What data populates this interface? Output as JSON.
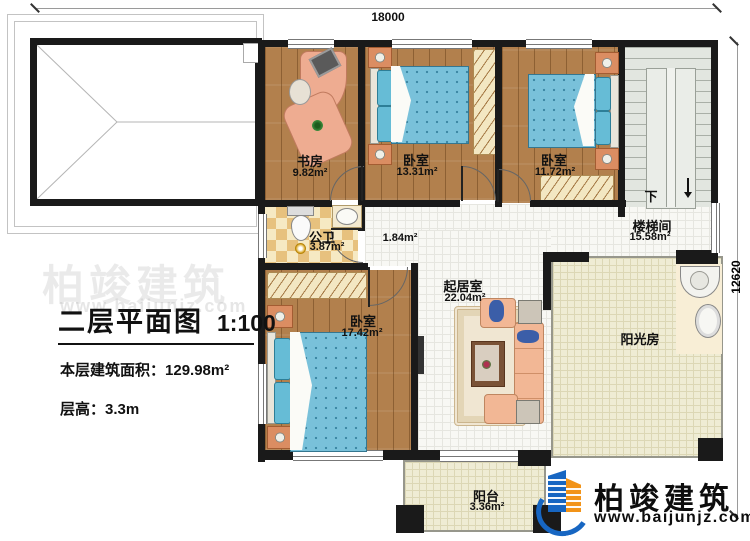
{
  "meta": {
    "dim_top": "18000",
    "dim_right": "12620"
  },
  "title_block": {
    "title": "二层平面图",
    "scale": "1:100",
    "area_label": "本层建筑面积：",
    "area_value": "129.98m²",
    "height_label": "层高：",
    "height_value": "3.3m"
  },
  "rooms": {
    "study": {
      "name": "书房",
      "area": "9.82m²"
    },
    "bedroom1": {
      "name": "卧室",
      "area": "13.31m²"
    },
    "bedroom2": {
      "name": "卧室",
      "area": "11.72m²"
    },
    "bedroom3": {
      "name": "卧室",
      "area": "17.42m²"
    },
    "bath": {
      "name": "公卫",
      "area": "3.87m²"
    },
    "hall": {
      "area": "1.84m²"
    },
    "living": {
      "name": "起居室",
      "area": "22.04m²"
    },
    "stair": {
      "name": "楼梯间",
      "area": "15.58m²",
      "down_label": "下"
    },
    "sunroom": {
      "name": "阳光房"
    },
    "balcony": {
      "name": "阳台",
      "area": "3.36m²"
    }
  },
  "logo": {
    "brand": "柏竣建筑",
    "url": "www.baijunjz.com"
  },
  "watermark": {
    "brand": "柏竣建筑",
    "url": "www.baijunjz.com"
  },
  "colors": {
    "wall": "#1a1a1a",
    "wood_floor": "#b2804d",
    "white_tile": "#f8f8f4",
    "cream_tile": "#efecd4",
    "checker_tile": "#e7c17e",
    "bed_blue": "#79c1da",
    "furniture_salmon": "#f2b795",
    "brand_blue": "#1766c2",
    "brand_orange": "#f29318"
  }
}
